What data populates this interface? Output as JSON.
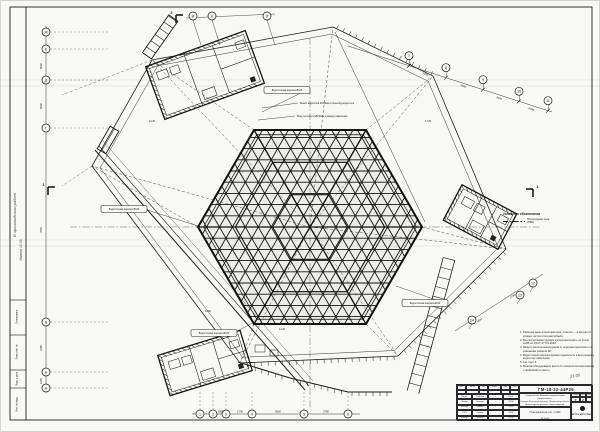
{
  "axes": {
    "top": [
      "И",
      "К",
      "Л"
    ],
    "left": [
      "Ж",
      "Е",
      "Д",
      "Г",
      "В",
      "Б",
      "А"
    ],
    "bottom": [
      "1",
      "2",
      "3",
      "4",
      "5",
      "6"
    ],
    "diag": [
      "7",
      "8",
      "9",
      "10",
      "11"
    ],
    "br": [
      "12",
      "13",
      "14"
    ]
  },
  "dims": [
    "9000",
    "9000",
    "9000",
    "9000",
    "6000",
    "9000",
    "7950",
    "2180",
    "1240",
    "8350",
    "1730",
    "5600",
    "2780",
    "2780",
    "5600"
  ],
  "labels": {
    "pills": [
      "Водосточная воронка Ø100",
      "Водосточная воронка Ø100",
      "Водосточная воронка Ø150",
      "Водосточная воронка Ø100"
    ],
    "texts": [
      "Вынос водостока Ø150мм в проектируемую сеть",
      "Ввод теплосети Ø150мм в камеру павильона"
    ],
    "elevations": [
      "19.80",
      "14.40",
      "21.30",
      "17.25"
    ]
  },
  "section_marks": [
    "2",
    "1",
    "1"
  ],
  "legend": {
    "title": "Условные обозначения",
    "item": "Пешеходная зона\n(ПВК)"
  },
  "notes": {
    "items": [
      "Размеры даны в миллиметрах, отметки — в метрах от уровня чистого пола вестибюля.",
      "Все металлоконструкции купола выполнить из стали С245 по ГОСТ 27772-2015.",
      "Защиту металлоконструкций от коррозии выполнять по указаниям раздела АР.",
      "Водосточные воронки кровли подключить к внутреннему водостоку павильона.",
      "См. лист 3.",
      "Монтаж оборудования вести по технологическим картам с привязкой по месту."
    ],
    "handnote": "21.05"
  },
  "margin": {
    "handwriting1": "В производство работ",
    "handwriting2": "Иванов 12.03",
    "strip_labels": [
      "Согласовано",
      "Взам. инв. №",
      "Подп. и дата",
      "Инв. № подл."
    ]
  },
  "title_block": {
    "number": "ГМ-18-22-44Р25",
    "desc": "Строительство Большой кольцевой линии метрополитена.\nСтанция «Кленовый бульвар». Наземный вестибюль.\nАрхитектурные решения. Купол покрытия.\nСхема расположения элементов кровли.",
    "title1": "План кровли на отм. +7,000",
    "title2": "М 1:100",
    "stage_label": "Стадия",
    "stage": "Р",
    "sheet_label": "Лист",
    "sheet": "2",
    "sheets_label": "Листов",
    "sheets": "",
    "org": "МЕТРОГИПРОТРАНС",
    "rev_headers": [
      "Изм.",
      "Кол.уч.",
      "Лист",
      "№ док.",
      "Подп.",
      "Дата"
    ],
    "roles": [
      {
        "r": "Разраб.",
        "n": "Смирнов",
        "d": "03.03"
      },
      {
        "r": "Провер.",
        "n": "Ковалёв",
        "d": "03.03"
      },
      {
        "r": "Нач.отд.",
        "n": "Белова",
        "d": "03.03"
      },
      {
        "r": "ГИП",
        "n": "Громов",
        "d": "03.03"
      },
      {
        "r": "Н.контр.",
        "n": "Ильина",
        "d": "03.03"
      }
    ]
  }
}
